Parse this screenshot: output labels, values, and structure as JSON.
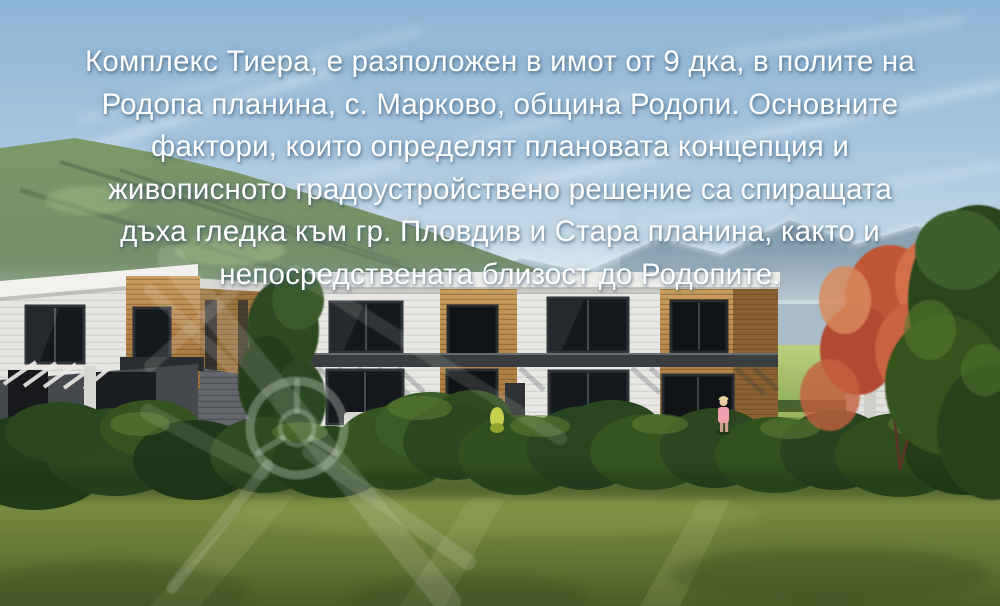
{
  "overlay": {
    "lines": [
      "Комплекс Тиера, е разположен в имот от 9 дка, в полите на",
      "Родопа планина, с. Марково, община Родопи. Основните",
      "фактори, които определят плановата концепция и",
      "живописното градоустройствено решение са спиращата",
      "дъха гледка към гр. Пловдив и Стара планина, както и",
      "непосредствената близост до Родопите."
    ]
  },
  "scene": {
    "watermark": "crossed-emblem-watermark",
    "colors": {
      "sky_top": "#8db5d6",
      "sky_horizon": "#d9e6ee",
      "mountain_green": "#5c7a4e",
      "mountain_distant": "#8aa2b2",
      "wall_white": "#e8e7e3",
      "wood_cladding": "#b5854a",
      "window_glass": "#14171b",
      "dark_band": "#3a3d3f",
      "grass": "#75883d",
      "bushes": "#33511f",
      "autumn_tree": "#c05538",
      "overlay_text": "#ffffff"
    }
  }
}
